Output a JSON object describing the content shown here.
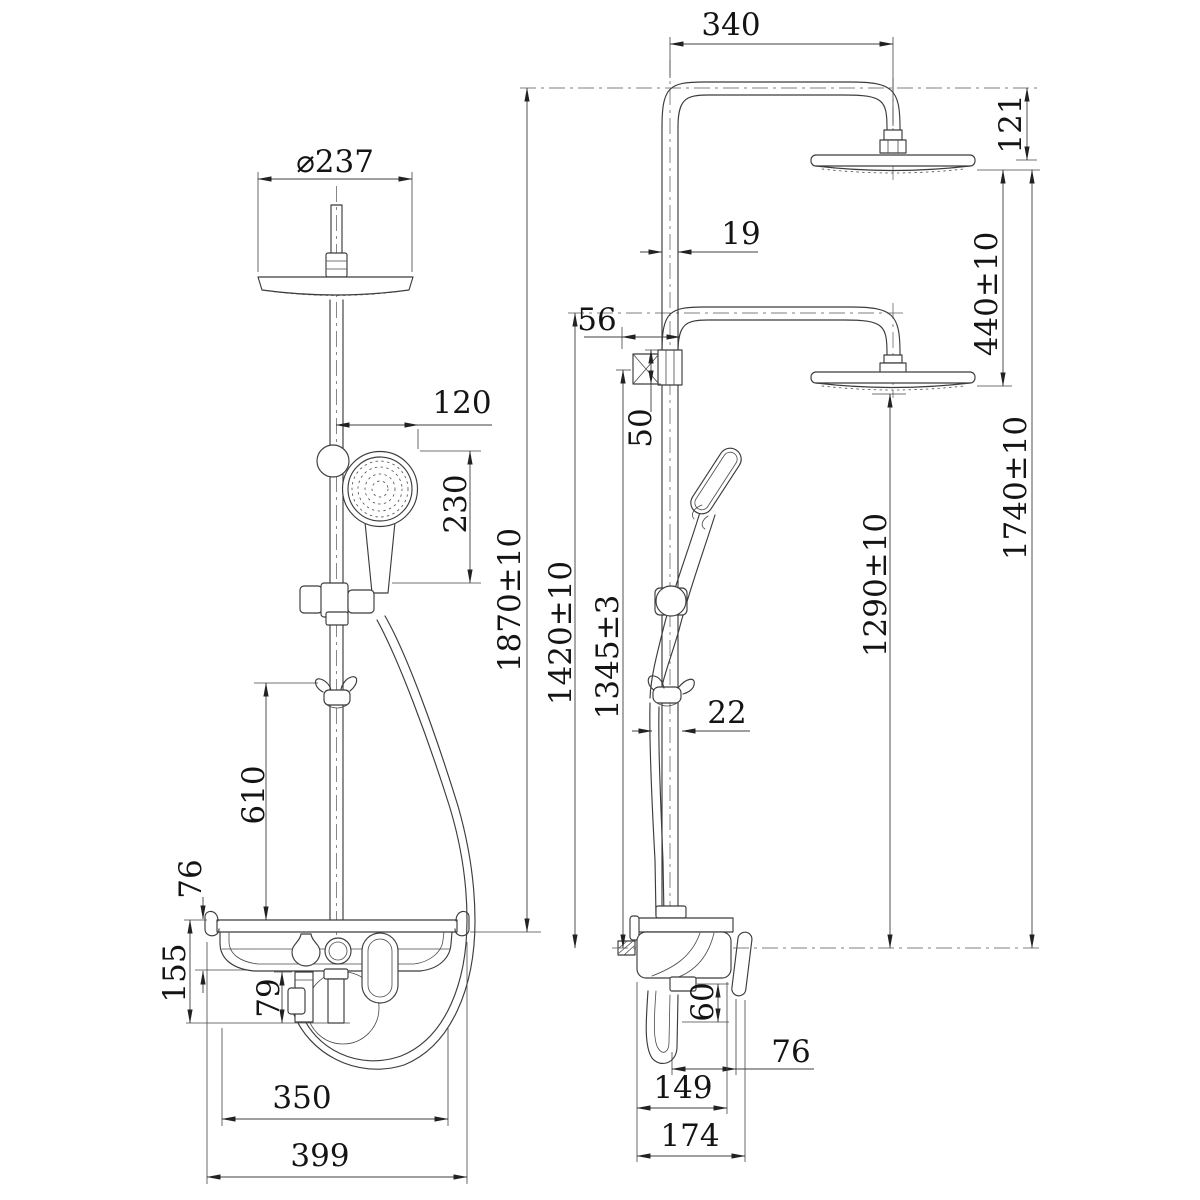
{
  "palette": {
    "line_color": "#3c3c3c",
    "text_color": "#141414",
    "background": "#ffffff"
  },
  "drawing": {
    "type": "technical dimension drawing",
    "subject": "dual-head shower column with shelf mixer",
    "views": [
      "front",
      "side"
    ]
  },
  "front": {
    "head_diameter": "⌀237",
    "handshower_offset": "120",
    "handshower_length": "230",
    "hook_height": "610",
    "shelf_thickness": "76",
    "shelf_drop": "155",
    "under_shelf": "79",
    "shelf_width": "350",
    "shelf_full_width": "399",
    "total_height": "1870±10"
  },
  "side": {
    "arm_reach": "340",
    "head_drop": "121",
    "pipe_dia": "19",
    "head_gap": "440±10",
    "wall_clearance": "56",
    "union_size": "50",
    "arm_height": "1740±10",
    "lower_arm_height": "1420±10",
    "inlet_height": "1345±3",
    "lower_head_height": "1290±10",
    "hose_gap": "22",
    "outlet_drop": "60",
    "front_clearance": "76",
    "body_depth": "149",
    "overall_depth": "174"
  }
}
